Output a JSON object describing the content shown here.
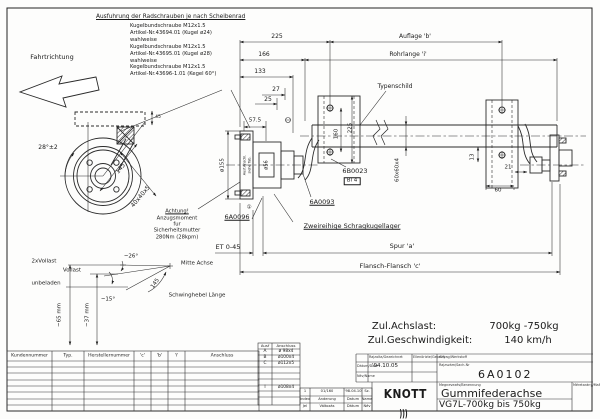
{
  "note": {
    "title": "Ausfuhrung der Radschrauben je nach Scheibenrad",
    "lines": [
      "Kugelbundschraube M12x1.5",
      "Artikel-Nr.43694.01 (Kugel ø24)",
      "wahlweise",
      "Kugelbundschraube M12x1.5",
      "Artikel-Nr.43695.01 (Kugel ø28)",
      "wahlweise",
      "Kegelbundschraube M12x1.5",
      "Artikel-Nr.43696-1.01 (Kegel 60°)"
    ]
  },
  "floats": [
    {
      "name": "fahrtrichtung-label",
      "t": "Fahrtrichtung",
      "x": 52,
      "y": 57,
      "fs": 6.5
    },
    {
      "name": "dim-225-top",
      "t": "225",
      "x": 277,
      "y": 37,
      "fs": 6
    },
    {
      "name": "auflage-b-label",
      "t": "Auflage 'b'",
      "x": 415,
      "y": 37,
      "fs": 6
    },
    {
      "name": "dim-166",
      "t": "166",
      "x": 264,
      "y": 55,
      "fs": 6
    },
    {
      "name": "rohrlange-label",
      "t": "Rohrlange 'i'",
      "x": 408,
      "y": 55,
      "fs": 6
    },
    {
      "name": "dim-133",
      "t": "133",
      "x": 260,
      "y": 72,
      "fs": 6
    },
    {
      "name": "dim-27",
      "t": "27",
      "x": 276,
      "y": 90,
      "fs": 6
    },
    {
      "name": "dim-25",
      "t": "25",
      "x": 268,
      "y": 100,
      "fs": 6
    },
    {
      "name": "dim-57-5",
      "t": "57.5",
      "x": 255,
      "y": 121,
      "fs": 5.5
    },
    {
      "name": "typenschild-label",
      "t": "Typenschild",
      "x": 395,
      "y": 87,
      "fs": 6
    },
    {
      "name": "dim-160-vert",
      "t": "160",
      "x": 337,
      "y": 134,
      "fs": 5.5,
      "r": -90
    },
    {
      "name": "dim-225-vert",
      "t": "225",
      "x": 351,
      "y": 128,
      "fs": 5.5,
      "r": -90
    },
    {
      "name": "tube-profile-label",
      "t": "60x60x4",
      "x": 398,
      "y": 170,
      "fs": 5.5,
      "r": -90
    },
    {
      "name": "callout-6b0023",
      "t": "6B0023",
      "x": 355,
      "y": 171,
      "fs": 6.5
    },
    {
      "name": "callout-bl4",
      "t": "Bl 4",
      "x": 352,
      "y": 181,
      "fs": 5.5,
      "b": 1
    },
    {
      "name": "callout-6a0093",
      "t": "6A0093",
      "x": 322,
      "y": 202,
      "fs": 6.5,
      "u": 1
    },
    {
      "name": "callout-6a0096",
      "t": "6A0096",
      "x": 237,
      "y": 217,
      "fs": 6.5,
      "u": 1
    },
    {
      "name": "ref-circle-1",
      "t": "①",
      "x": 249,
      "y": 208,
      "fs": 5.5
    },
    {
      "name": "dim-dia155",
      "t": "ø155",
      "x": 223,
      "y": 165,
      "fs": 5.5,
      "r": -90
    },
    {
      "name": "dim-dia56",
      "t": "ø56",
      "x": 267,
      "y": 165,
      "fs": 5,
      "r": -90
    },
    {
      "name": "ausf-anschl-note",
      "t": "Ausf.Anschl.",
      "x": 245,
      "y": 165,
      "fs": 3.4,
      "r": -90
    },
    {
      "name": "siehe-tab-note",
      "t": "siehe Tab.",
      "x": 250,
      "y": 165,
      "fs": 3.4,
      "r": -90
    },
    {
      "name": "dim-angle-28",
      "t": "28°±2",
      "x": 48,
      "y": 148,
      "fs": 6
    },
    {
      "name": "dim-145-arm",
      "t": "145",
      "x": 121,
      "y": 169,
      "fs": 6,
      "r": -52
    },
    {
      "name": "dim-40x40x5",
      "t": "40x40x5",
      "x": 141,
      "y": 197,
      "fs": 6,
      "r": -50
    },
    {
      "name": "dim-45",
      "t": "45",
      "x": 158,
      "y": 118,
      "fs": 4.5
    },
    {
      "name": "warning-line-1",
      "t": "Achtung!",
      "x": 177,
      "y": 212,
      "fs": 5.2,
      "u": 1
    },
    {
      "name": "warning-line-2",
      "t": "Anzugsmoment",
      "x": 177,
      "y": 219,
      "fs": 5.2
    },
    {
      "name": "warning-line-3",
      "t": "fur",
      "x": 177,
      "y": 225,
      "fs": 5.2
    },
    {
      "name": "warning-line-4",
      "t": "Sicherheitsmutter",
      "x": 177,
      "y": 231,
      "fs": 5.2
    },
    {
      "name": "warning-line-5",
      "t": "280Nm (28kpm)",
      "x": 177,
      "y": 238,
      "fs": 5.2
    },
    {
      "name": "et-label",
      "t": "ET 0-45",
      "x": 228,
      "y": 247,
      "fs": 6.5
    },
    {
      "name": "lager-label",
      "t": "Zweireihige Schragkugellager",
      "x": 352,
      "y": 226,
      "fs": 6.5,
      "u": 1
    },
    {
      "name": "spur-label",
      "t": "Spur 'a'",
      "x": 402,
      "y": 246,
      "fs": 6.5
    },
    {
      "name": "flansch-label",
      "t": "Flansch-Flansch 'c'",
      "x": 390,
      "y": 266,
      "fs": 6.5
    },
    {
      "name": "dim-13",
      "t": "13",
      "x": 473,
      "y": 157,
      "fs": 5.5,
      "r": -90
    },
    {
      "name": "dim-60",
      "t": "60",
      "x": 498,
      "y": 191,
      "fs": 5.5
    },
    {
      "name": "dim-21",
      "t": "21",
      "x": 508,
      "y": 168,
      "fs": 5.5
    },
    {
      "name": "load-2xvollast",
      "t": "2xVollast",
      "x": 44,
      "y": 262,
      "fs": 5.5
    },
    {
      "name": "load-vollast",
      "t": "Vollast",
      "x": 72,
      "y": 271,
      "fs": 5.5
    },
    {
      "name": "load-unbeladen",
      "t": "unbeladen",
      "x": 46,
      "y": 284,
      "fs": 5.5
    },
    {
      "name": "angle-26",
      "t": "~26°",
      "x": 131,
      "y": 257,
      "fs": 5.5
    },
    {
      "name": "angle-15",
      "t": "~15°",
      "x": 108,
      "y": 300,
      "fs": 5.5
    },
    {
      "name": "dim-145-lever",
      "t": "145",
      "x": 156,
      "y": 284,
      "fs": 5.5,
      "r": -55
    },
    {
      "name": "mitte-achse-label",
      "t": "Mitte Achse",
      "x": 197,
      "y": 264,
      "fs": 5.5
    },
    {
      "name": "schwinghebel-label",
      "t": "Schwinghebel Länge",
      "x": 197,
      "y": 296,
      "fs": 5.5
    },
    {
      "name": "dim-65mm",
      "t": "~65 mm",
      "x": 60,
      "y": 315,
      "fs": 5.5,
      "r": -90
    },
    {
      "name": "dim-37mm",
      "t": "~37 mm",
      "x": 88,
      "y": 315,
      "fs": 5.5,
      "r": -90
    },
    {
      "name": "achslast-label",
      "t": "Zul.Achslast:",
      "x": 404,
      "y": 327,
      "fs": 10
    },
    {
      "name": "achslast-value",
      "t": "700kg -750kg",
      "x": 524,
      "y": 327,
      "fs": 10
    },
    {
      "name": "geschw-label",
      "t": "Zul.Geschwindigkeit:",
      "x": 420,
      "y": 341,
      "fs": 10
    },
    {
      "name": "geschw-value",
      "t": "140 km/h",
      "x": 528,
      "y": 341,
      "fs": 10
    }
  ],
  "customer_table": {
    "headers": [
      "Kundennummer",
      "Typ.",
      "Herstellernummer",
      "'c'",
      "'b'",
      "'i'",
      "Anschluss"
    ]
  },
  "ausf_table": {
    "headers": [
      "Ausf",
      "Anschluss"
    ],
    "rows": [
      [
        "A",
        "ø 98x4"
      ],
      [
        "B",
        "ø100x4"
      ],
      [
        "C",
        "ø112x5"
      ],
      [
        "",
        ""
      ],
      [
        "",
        ""
      ],
      [
        "",
        ""
      ],
      [
        "I",
        "ø108x4"
      ],
      [
        "",
        ""
      ],
      [
        "",
        ""
      ]
    ]
  },
  "revision": {
    "rows": [
      [
        "1",
        "01/160",
        "'98.04.10",
        "Sz."
      ],
      [
        "Index",
        "Anderung",
        "Datum",
        "Name"
      ],
      [
        "Jel",
        "Változás",
        "Dátum",
        "Név"
      ]
    ]
  },
  "titleblock": {
    "gezeichnet_label": "Rajzolta/Gezeichnet",
    "geprueft_label": "Ellenörizte/Geprüft",
    "werkstoff_label": "Anyag/Werkstoff",
    "datum_label": "Dátum/Date",
    "datum_value": "'94.10.05",
    "name_label": "Név/Name",
    "sachnr_label": "Rajzszám/Sach-Nr",
    "sachnr_value": "6A0102",
    "benennung_label": "Megnevezés/Benennung",
    "title": "Gummifederachse",
    "subtitle": "VG7L-700kg bis 750kg",
    "massstab_label": "Méretarány/Maßstab",
    "brand": {
      "name": "KNOTT",
      "mark": ")))",
      "sub1": "Bremsen   Achsen",
      "sub2": "KNOTT GmbH D 83125 Eggstätt"
    }
  },
  "colors": {
    "line": "#1a1a1a",
    "paper": "#fdfdfc"
  }
}
